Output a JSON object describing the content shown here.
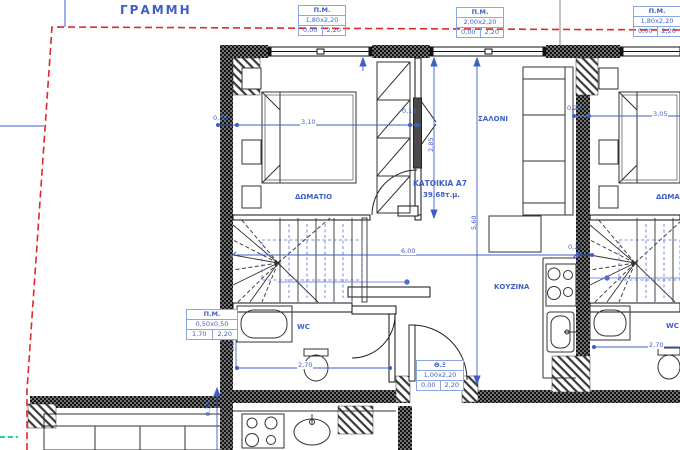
{
  "site": {
    "boundary_label": "ΓΡΑΜΜΗ"
  },
  "unit": {
    "name": "ΚΑΤΟΙΚΙΑ Α7",
    "area": "39,68τ.μ."
  },
  "rooms": {
    "bedroom_left": "ΔΩΜΑΤΙΟ",
    "bedroom_right": "ΔΩΜΑΤΙΟ",
    "living": "ΣΑΛΟΝΙ",
    "kitchen": "ΚΟΥΖΙΝΑ",
    "wc_left": "WC",
    "wc_right": "WC"
  },
  "openings": {
    "top1": {
      "header": "Π.Μ.",
      "size": "1,80x2,20",
      "sill": "0,00",
      "height": "2,20"
    },
    "top2": {
      "header": "Π.Μ.",
      "size": "2,00x2,20",
      "sill": "0,00",
      "height": "2,20"
    },
    "top3": {
      "header": "Π.Μ.",
      "size": "1,80x2,20",
      "sill": "0,00",
      "height": "2,20"
    },
    "wc": {
      "header": "Π.Μ.",
      "size": "0,50x0,50",
      "sill": "1,70",
      "height": "2,20"
    },
    "entry": {
      "header": "Θ.Ξ",
      "size": "1,00x2,20",
      "sill": "0,00",
      "height": "2,20"
    }
  },
  "dims": {
    "left_wall": "0,30",
    "bed_span": "3,10",
    "bedroom_depth": "2,85",
    "partition": "0,10",
    "living_depth": "5,60",
    "unit_width": "6,00",
    "wc_width": "2,70",
    "wc_depth": "1,25",
    "right_offset": "0,20",
    "bed_span_right": "3,05",
    "wc_width_right": "2,70",
    "lower_offset": "0,30",
    "stair_offset": "0,20"
  },
  "colors": {
    "annotation_blue": "#3f5fc8",
    "tag_border_blue": "#8aa7e0",
    "boundary_red": "#e02828",
    "marker_green": "#2fd0a0",
    "line_black": "#111111"
  }
}
